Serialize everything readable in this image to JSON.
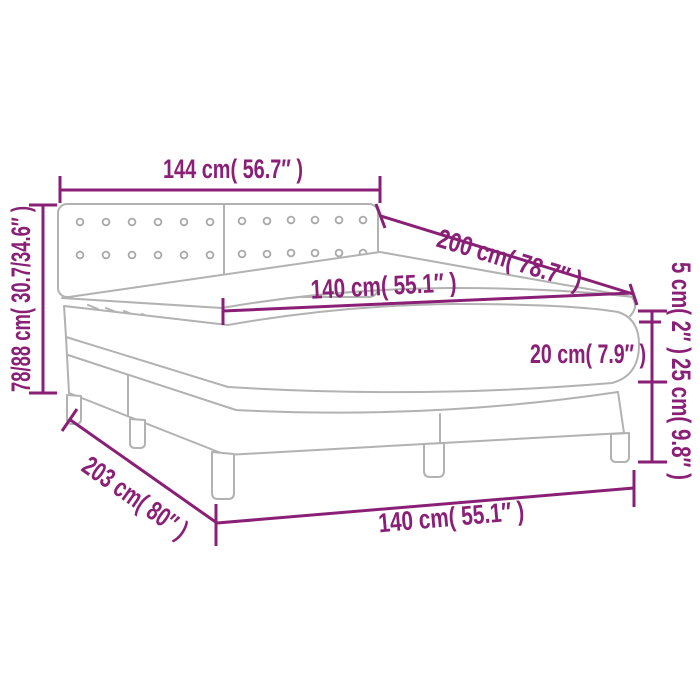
{
  "diagram": {
    "title": "Box spring bed with mattress and topper — dimension diagram",
    "type": "product-dimension-diagram",
    "colors": {
      "dimension_color": "#8a1f76",
      "line_art_color": "#b2b2b2",
      "background": "#ffffff"
    }
  },
  "labels": {
    "headboard_width": "144 cm( 56.7″ )",
    "bed_length": "200 cm( 78.7″ )",
    "mattress_width": "140 cm( 55.1″ )",
    "total_height": "78/88 cm( 30.7/34.6″ )",
    "topper_height": "5 cm( 2″ )",
    "mattress_height": "20 cm( 7.9″ )",
    "base_height": "25 cm( 9.8″ )",
    "base_length": "203 cm( 80″ )",
    "base_width": "140 cm( 55.1″ )"
  }
}
